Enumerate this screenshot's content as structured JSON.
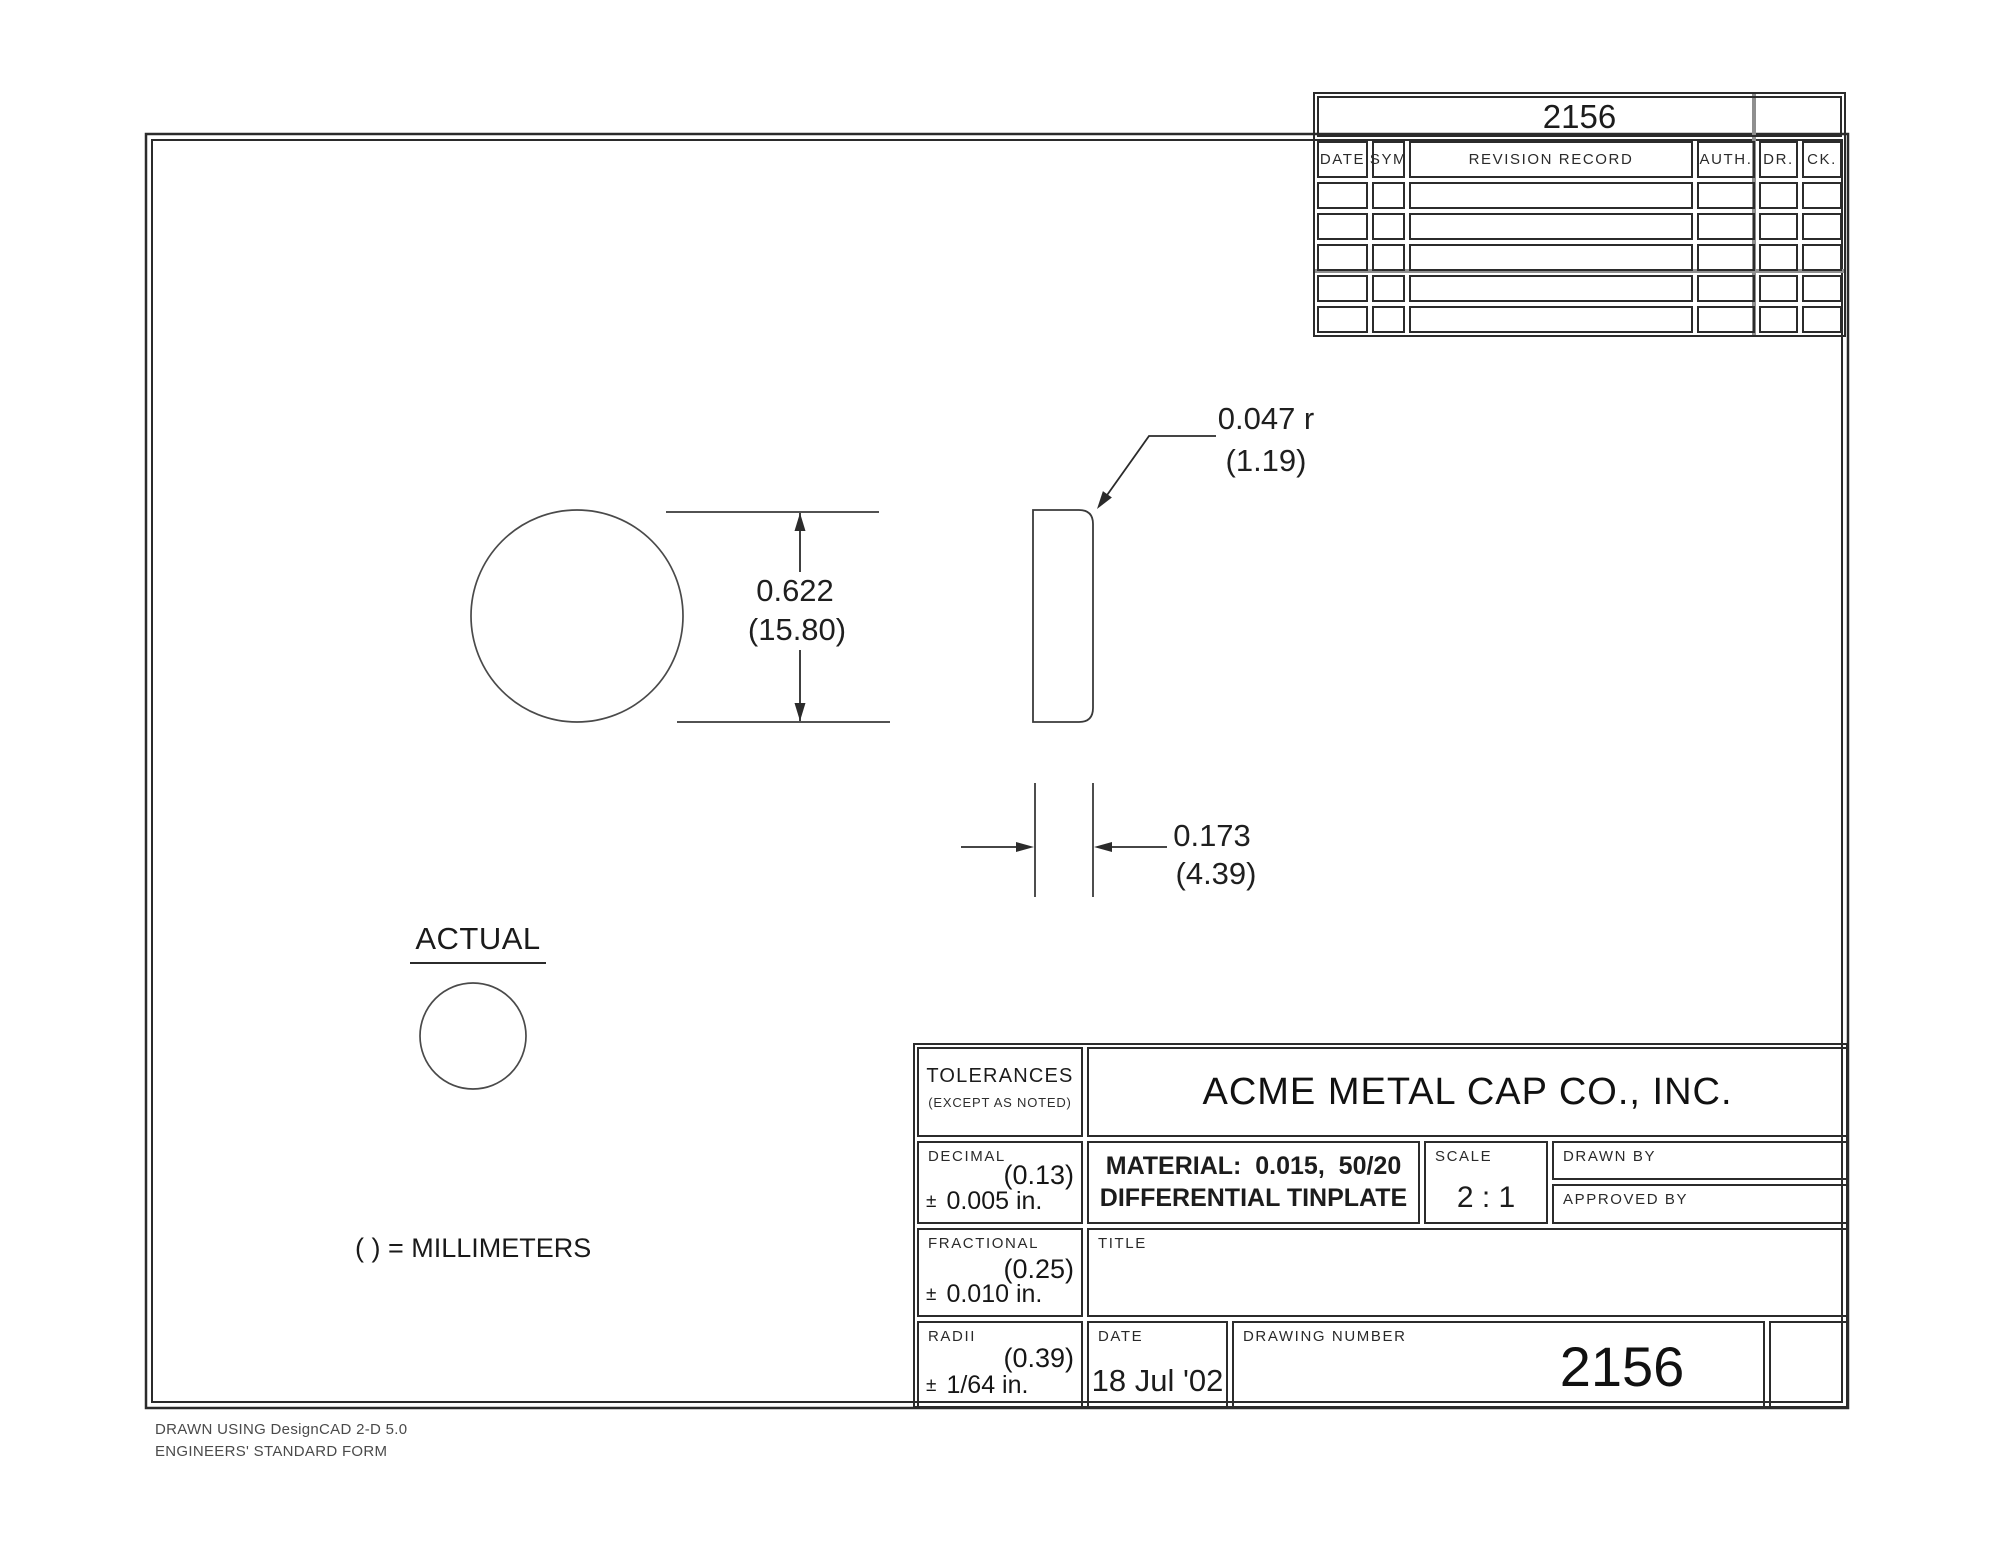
{
  "revision_table": {
    "header_number": "2156",
    "columns": [
      "DATE",
      "SYM",
      "REVISION RECORD",
      "AUTH.",
      "DR.",
      "CK."
    ],
    "empty_rows": 5
  },
  "drawing": {
    "diameter": {
      "inches": "0.622",
      "mm": "(15.80)"
    },
    "corner_radius": {
      "inches": "0.047 r",
      "mm": "(1.19)"
    },
    "thickness": {
      "inches": "0.173",
      "mm": "(4.39)"
    },
    "actual_label": "ACTUAL",
    "units_note": "( ) = MILLIMETERS"
  },
  "title_block": {
    "tolerances": {
      "title": "TOLERANCES",
      "subtitle": "(EXCEPT AS NOTED)",
      "decimal": {
        "label": "DECIMAL",
        "mm": "(0.13)",
        "pm": "±",
        "value": "0.005 in."
      },
      "fractional": {
        "label": "FRACTIONAL",
        "mm": "(0.25)",
        "pm": "±",
        "value": "0.010 in."
      },
      "radii": {
        "label": "RADII",
        "mm": "(0.39)",
        "pm": "±",
        "value": "1/64 in."
      }
    },
    "company": "ACME METAL CAP CO., INC.",
    "material_line1": "MATERIAL:  0.015,  50/20",
    "material_line2": "DIFFERENTIAL TINPLATE",
    "scale": {
      "label": "SCALE",
      "value": "2 : 1"
    },
    "drawn_by_label": "DRAWN BY",
    "approved_by_label": "APPROVED BY",
    "title_label": "TITLE",
    "date": {
      "label": "DATE",
      "value": "18 Jul '02"
    },
    "drawing_number": {
      "label": "DRAWING NUMBER",
      "value": "2156"
    }
  },
  "footer": {
    "line1": "DRAWN USING DesignCAD 2-D 5.0",
    "line2": "ENGINEERS' STANDARD FORM"
  },
  "colors": {
    "line": "#2b2b2b",
    "thin_line": "#4a4a4a",
    "gray_line": "#8f8f8f",
    "text": "#1c1c1c"
  }
}
